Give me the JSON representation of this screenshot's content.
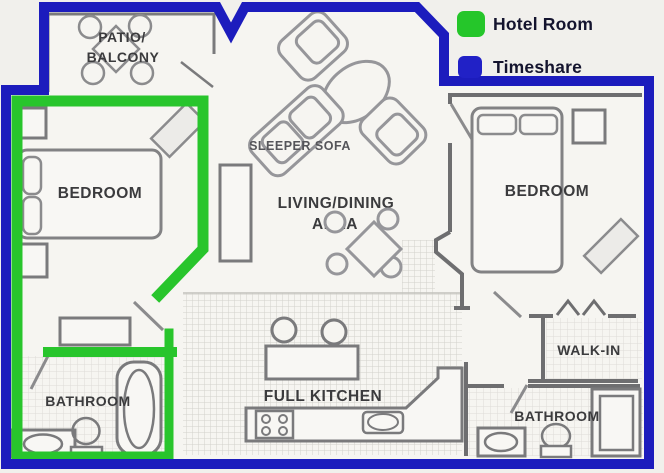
{
  "legend": {
    "items": [
      {
        "label": "Hotel Room",
        "color": "#25c62a"
      },
      {
        "label": "Timeshare",
        "color": "#2121c6"
      }
    ]
  },
  "colors": {
    "hotel_room_outline": "#28c52c",
    "timeshare_outline": "#1c1cbd",
    "walls": "#6e6e70"
  },
  "rooms": {
    "patio": {
      "line1": "PATIO/",
      "line2": "BALCONY"
    },
    "bedroom_left": {
      "label": "BEDROOM"
    },
    "bedroom_right": {
      "label": "BEDROOM"
    },
    "sitting": {
      "label": "SLEEPER SOFA"
    },
    "living": {
      "line1": "LIVING/DINING",
      "line2": "AREA"
    },
    "kitchen": {
      "label": "FULL KITCHEN"
    },
    "walk_in": {
      "label": "WALK-IN"
    },
    "bathroom_left": {
      "label": "BATHROOM"
    },
    "bathroom_right": {
      "label": "BATHROOM"
    }
  }
}
